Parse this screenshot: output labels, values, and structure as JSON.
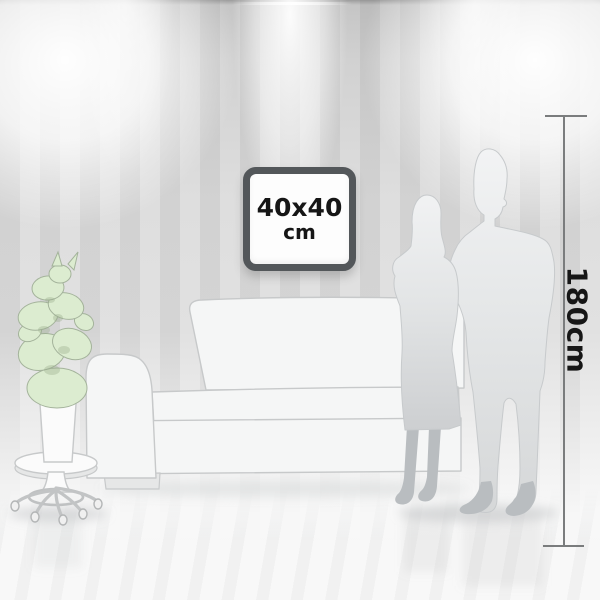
{
  "scene": {
    "frame": {
      "size_label": "40x40",
      "unit_label": "cm"
    },
    "ruler": {
      "label": "180cm"
    },
    "colors": {
      "wall_stripe_dark": "#d4d4d4",
      "wall_stripe_light": "#e1e1e1",
      "floor": "#f8f8f8",
      "frame_border": "#53575a",
      "frame_face": "#fdfdfd",
      "label_text": "#161616",
      "ruler_line": "#7a7c7d",
      "plant_green": "#dcecd0",
      "plant_outline": "#a4b39b",
      "furniture_fill": "#f5f6f6",
      "furniture_outline": "#c7c9ca",
      "silhouette_shadow": "#b9bdc0",
      "shadow_tint": "#a7aaac"
    }
  }
}
